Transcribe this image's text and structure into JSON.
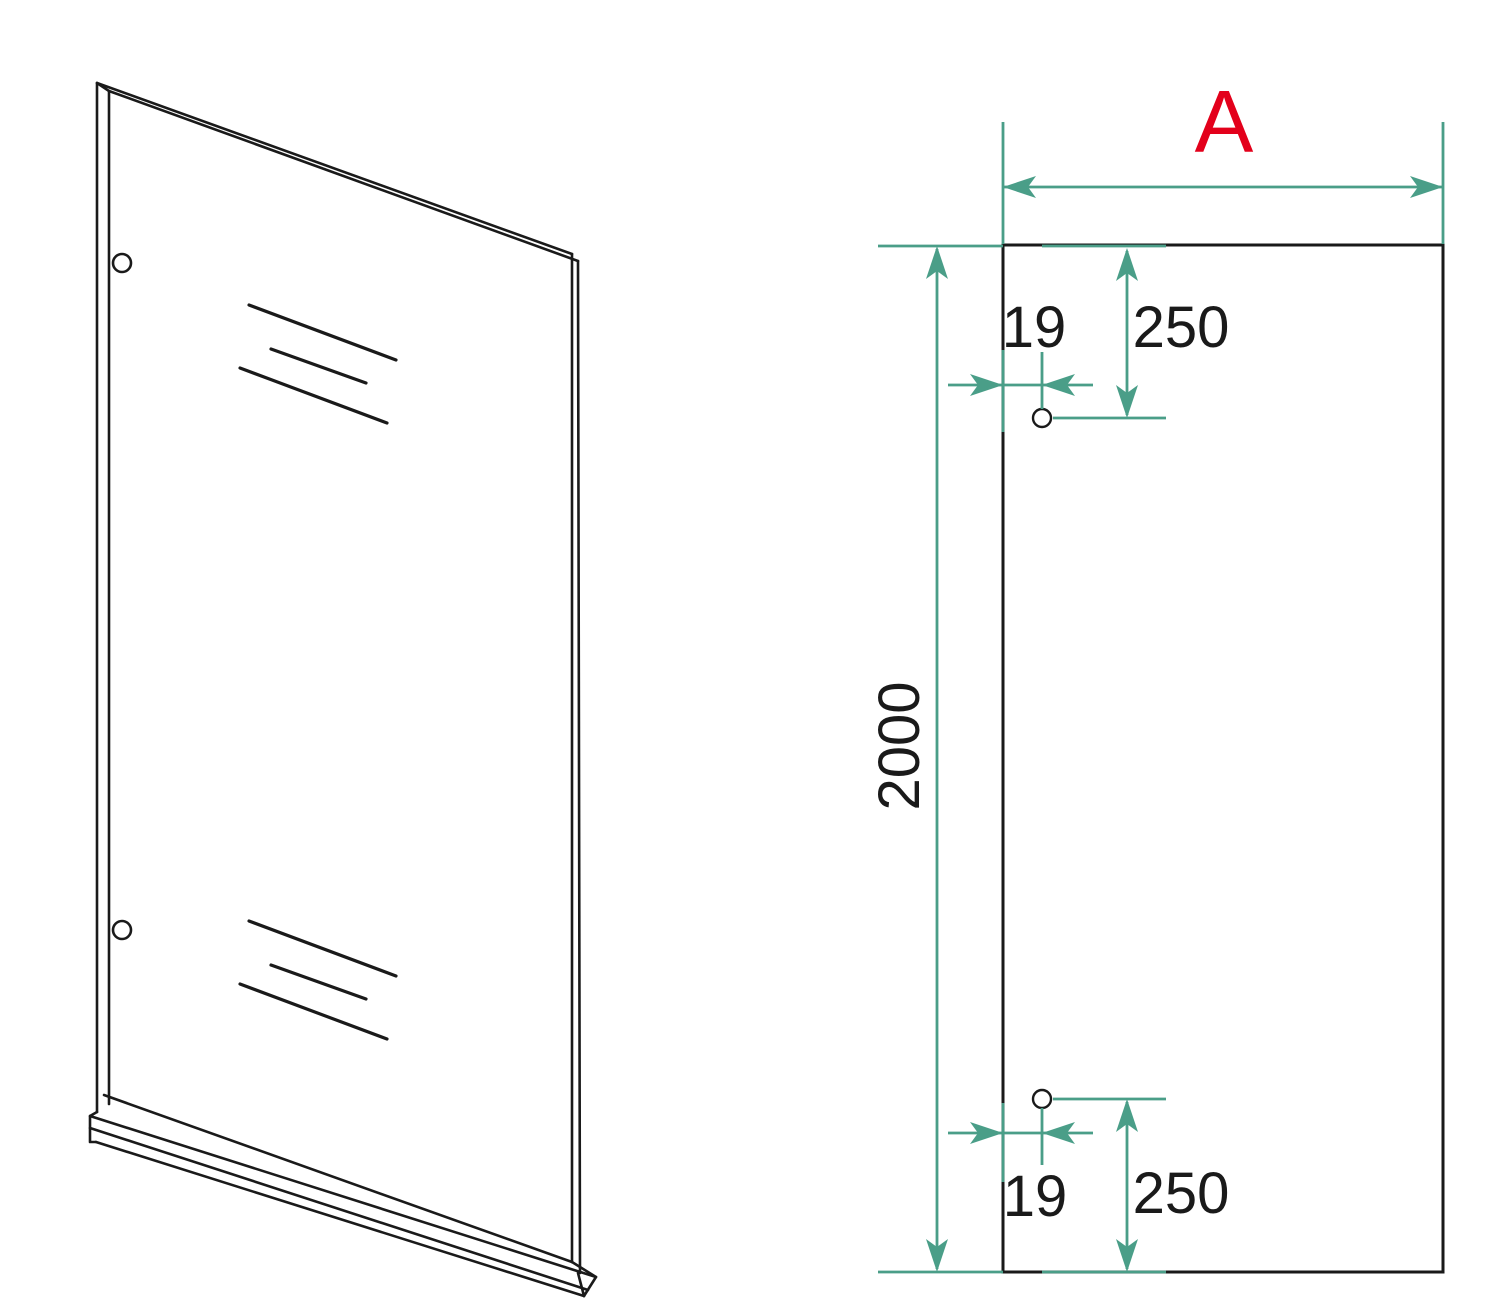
{
  "colors": {
    "line": "#1a1a1a",
    "dimension": "#4a9e88",
    "accent_red": "#e3001b",
    "background": "#ffffff"
  },
  "dims": {
    "width_label": "A",
    "height": "2000",
    "hole_top": {
      "from_edge": "19",
      "from_top": "250"
    },
    "hole_bottom": {
      "from_edge": "19",
      "from_bottom": "250"
    }
  }
}
